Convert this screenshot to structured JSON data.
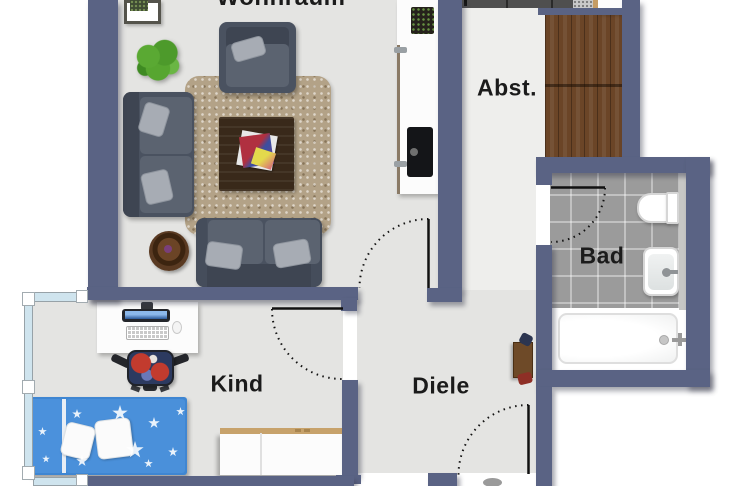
{
  "floorplan": {
    "rooms": [
      {
        "name": "living-room",
        "label": "Wohnraum"
      },
      {
        "name": "storage-room",
        "label": "Abst."
      },
      {
        "name": "bathroom",
        "label": "Bad"
      },
      {
        "name": "kids-room",
        "label": "Kind"
      },
      {
        "name": "hallway",
        "label": "Diele"
      }
    ],
    "colors": {
      "wall": "#5a6384",
      "floor": "#e4e4e2",
      "floor_light": "#eeeeec",
      "outside": "#ffffff",
      "bath_tile": "#9b9b9b",
      "wood": "#6b4527",
      "rug": "#b3a287",
      "bed_blue": "#4a90da",
      "sofa_gray": "#4a5260",
      "sideboard_trim": "#c7a26b",
      "window_glass": "#cfe4ee"
    }
  }
}
